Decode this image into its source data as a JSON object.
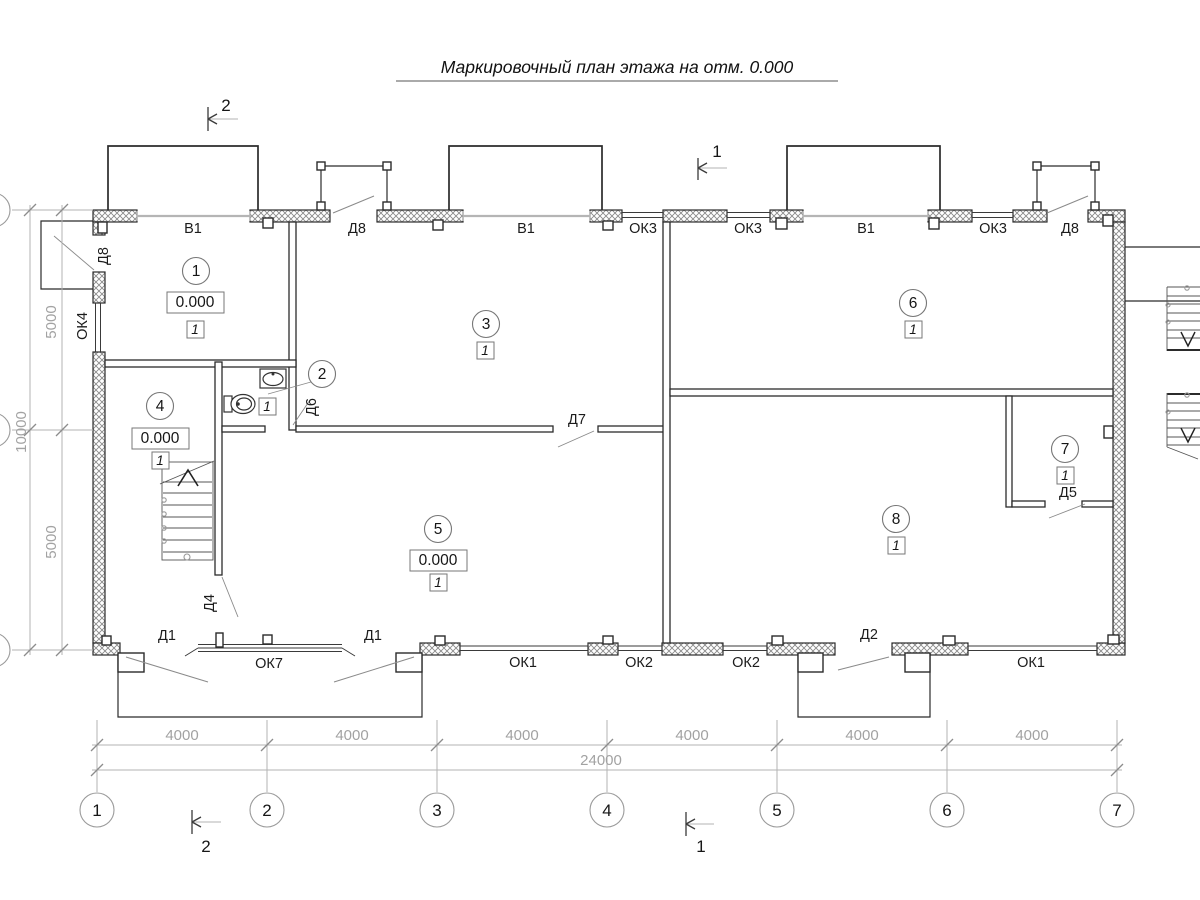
{
  "title": "Маркировочный план этажа на отм. 0.000",
  "rooms": [
    {
      "number": "1",
      "elevation": "0.000",
      "finish": "1"
    },
    {
      "number": "2",
      "finish": "1"
    },
    {
      "number": "3",
      "finish": "1"
    },
    {
      "number": "4",
      "elevation": "0.000",
      "finish": "1"
    },
    {
      "number": "5",
      "elevation": "0.000",
      "finish": "1"
    },
    {
      "number": "6",
      "finish": "1"
    },
    {
      "number": "7",
      "finish": "1"
    },
    {
      "number": "8",
      "finish": "1"
    }
  ],
  "openings": {
    "left_wall": [
      "Д8",
      "ОК4"
    ],
    "top_wall": [
      "В1",
      "Д8",
      "В1",
      "ОК3",
      "ОК3",
      "В1",
      "ОК3",
      "Д8"
    ],
    "bottom_wall": [
      "Д1",
      "ОК7",
      "Д1",
      "ОК1",
      "ОК2",
      "ОК2",
      "Д2",
      "ОК1"
    ],
    "interior": [
      "Д6",
      "Д7",
      "Д4",
      "Д5"
    ]
  },
  "dimensions": {
    "bottom_segments": [
      "4000",
      "4000",
      "4000",
      "4000",
      "4000",
      "4000"
    ],
    "bottom_total": "24000",
    "left_segments": [
      "5000",
      "5000"
    ],
    "left_total": "10000"
  },
  "axes": [
    "1",
    "2",
    "3",
    "4",
    "5",
    "6",
    "7"
  ],
  "sections": {
    "mark1": "1",
    "mark2": "2"
  },
  "fixtures": {
    "sink": "sink-icon",
    "toilet": "toilet-icon",
    "stairs_up": "stairs-up-icon",
    "stairs_down": "stairs-down-icon"
  },
  "colors": {
    "line": "#2b2b2b",
    "dim_line": "#b3b3b3",
    "dim_text": "#a2a2a2",
    "hatch": "#8a8a8a",
    "window_band": "#b5b5b5"
  }
}
